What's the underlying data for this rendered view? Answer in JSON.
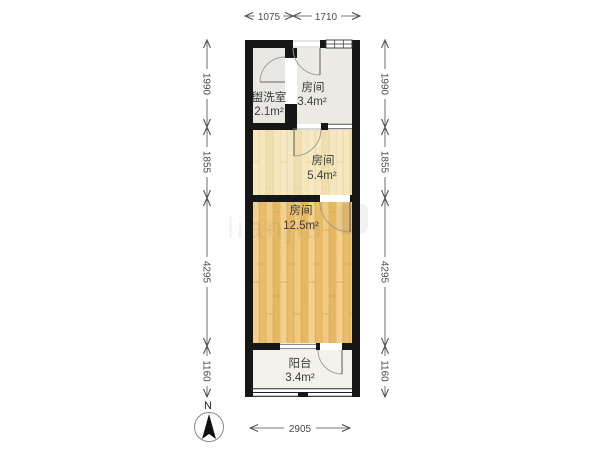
{
  "rooms": [
    {
      "name": "盥洗室",
      "area": "2.1m²"
    },
    {
      "name": "房间",
      "area": "3.4m²"
    },
    {
      "name": "房间",
      "area": "5.4m²"
    },
    {
      "name": "房间",
      "area": "12.5m²"
    },
    {
      "name": "阳台",
      "area": "3.4m²"
    }
  ],
  "dimensions": {
    "top": [
      "1075",
      "1710"
    ],
    "left": [
      "1990",
      "1855",
      "4295",
      "1160"
    ],
    "right": [
      "1990",
      "1855",
      "4295",
      "1160"
    ],
    "bottom": [
      "2905"
    ]
  },
  "compass": {
    "label": "N"
  },
  "watermark": {
    "text": "lianjia"
  },
  "colors": {
    "wall": "#161616",
    "room_grey": "#e9e8e3",
    "wood_light": "#f4e6bd",
    "wood_dark": "#eec87e",
    "balcony_floor": "#f2f1ec",
    "dim": "#4a4a4a"
  }
}
